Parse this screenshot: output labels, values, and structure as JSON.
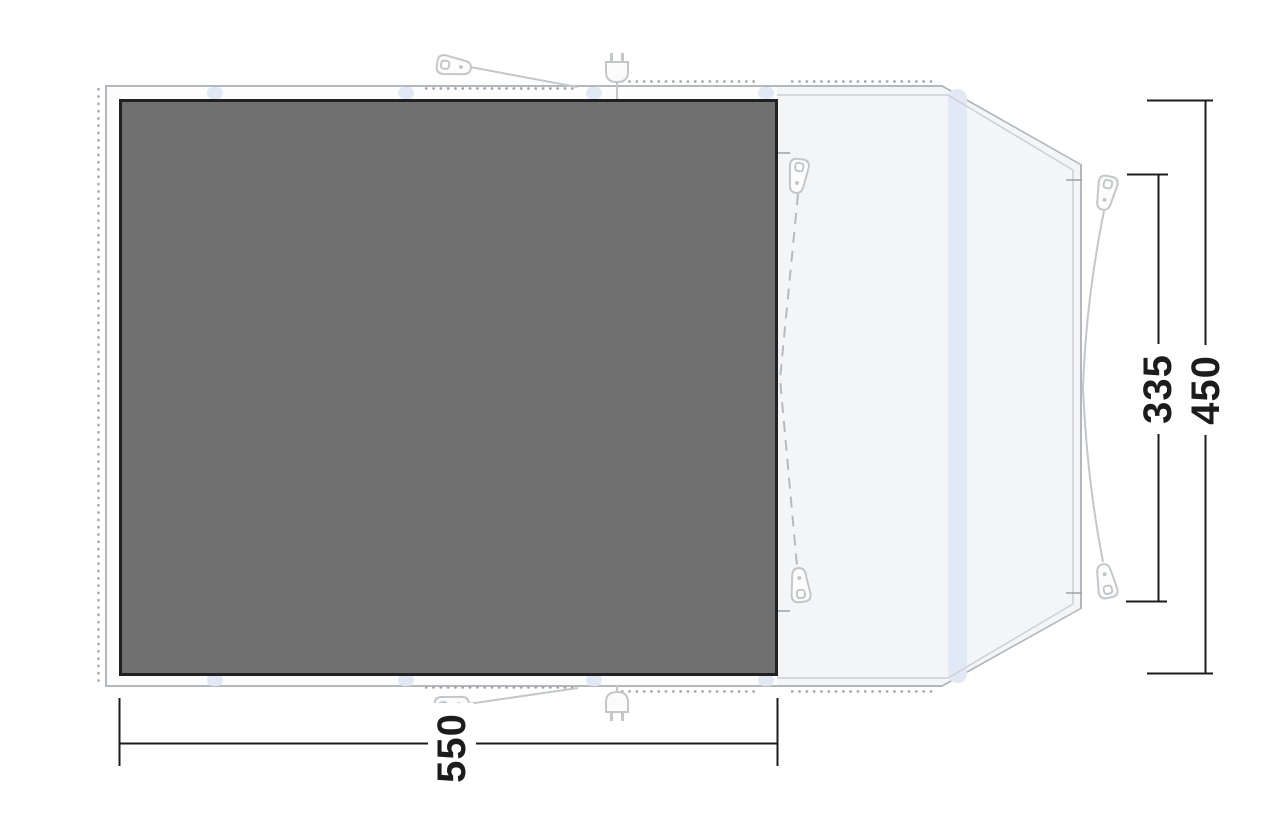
{
  "diagram": {
    "dimensions": {
      "width_label": "550",
      "inner_depth_label": "335",
      "outer_depth_label": "450"
    },
    "colors": {
      "groundsheet_fill": "#707070",
      "groundsheet_border": "#212121",
      "tent_outline": "#b3b8bd",
      "inner_seam": "#ccd0d4",
      "pole_accent_blue": "#e2e9f6",
      "right_section_fill": "#f4f5f7",
      "hardware_gray": "#c4c7ca",
      "dotted_line_gray": "#a0a4a8",
      "dimension_black": "#1c1c1e"
    },
    "icons": {
      "peg": "tent-peg-icon",
      "plug": "power-plug-icon"
    }
  }
}
